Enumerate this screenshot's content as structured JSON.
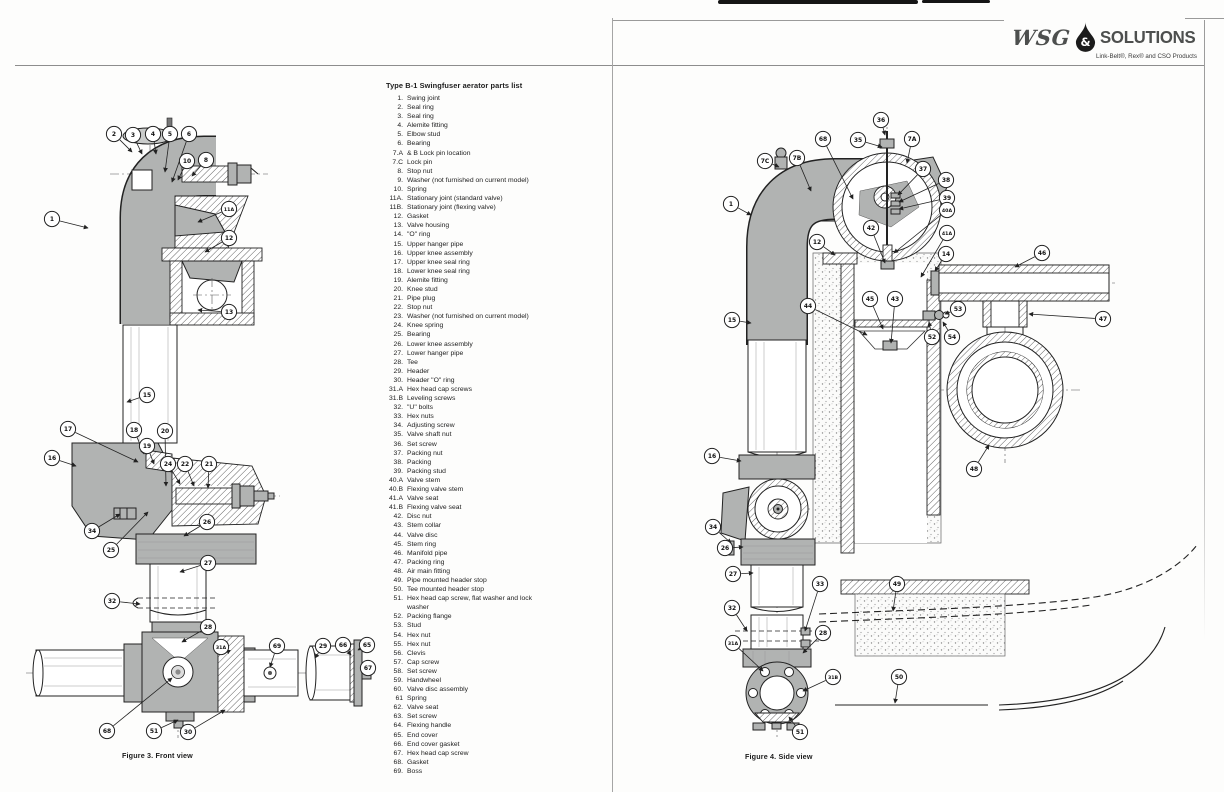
{
  "logo": {
    "wsg": "WSG",
    "amp": "&",
    "solutions": "SOLUTIONS",
    "tagline": "Link-Belt®, Rex® and CSO Products"
  },
  "parts_list": {
    "title": "Type B-1 Swingfuser aerator parts list",
    "items": [
      {
        "num": "1.",
        "label": "Swing joint"
      },
      {
        "num": "2.",
        "label": "Seal ring"
      },
      {
        "num": "3.",
        "label": "Seal ring"
      },
      {
        "num": "4.",
        "label": "Alemite fitting"
      },
      {
        "num": "5.",
        "label": "Elbow stud"
      },
      {
        "num": "6.",
        "label": "Bearing"
      },
      {
        "num": "7.A",
        "label": "& B Lock pin location"
      },
      {
        "num": "7.C",
        "label": "Lock pin"
      },
      {
        "num": "8.",
        "label": "Stop nut"
      },
      {
        "num": "9.",
        "label": "Washer (not furnished on current model)"
      },
      {
        "num": "10.",
        "label": "Spring"
      },
      {
        "num": "11A.",
        "label": "Stationary joint (standard valve)"
      },
      {
        "num": "11B.",
        "label": "Stationary joint (flexing valve)"
      },
      {
        "num": "12.",
        "label": "Gasket"
      },
      {
        "num": "13.",
        "label": "Valve housing"
      },
      {
        "num": "14.",
        "label": "\"O\" ring"
      },
      {
        "num": "15.",
        "label": "Upper hanger pipe"
      },
      {
        "num": "16.",
        "label": "Upper knee assembly"
      },
      {
        "num": "17.",
        "label": "Upper knee seal ring"
      },
      {
        "num": "18.",
        "label": "Lower knee seal ring"
      },
      {
        "num": "19.",
        "label": "Alemite fitting"
      },
      {
        "num": "20.",
        "label": "Knee stud"
      },
      {
        "num": "21.",
        "label": "Pipe plug"
      },
      {
        "num": "22.",
        "label": "Stop nut"
      },
      {
        "num": "23.",
        "label": "Washer (not furnished on current model)"
      },
      {
        "num": "24.",
        "label": "Knee spring"
      },
      {
        "num": "25.",
        "label": "Bearing"
      },
      {
        "num": "26.",
        "label": "Lower knee assembly"
      },
      {
        "num": "27.",
        "label": "Lower hanger pipe"
      },
      {
        "num": "28.",
        "label": "Tee"
      },
      {
        "num": "29.",
        "label": "Header"
      },
      {
        "num": "30.",
        "label": "Header \"O\" ring"
      },
      {
        "num": "31.A",
        "label": "Hex head cap screws"
      },
      {
        "num": "31.B",
        "label": "Leveling screws"
      },
      {
        "num": "32.",
        "label": "\"U\" bolts"
      },
      {
        "num": "33.",
        "label": "Hex nuts"
      },
      {
        "num": "34.",
        "label": "Adjusting screw"
      },
      {
        "num": "35.",
        "label": "Valve shaft nut"
      },
      {
        "num": "36.",
        "label": "Set screw"
      },
      {
        "num": "37.",
        "label": "Packing nut"
      },
      {
        "num": "38.",
        "label": "Packing"
      },
      {
        "num": "39.",
        "label": "Packing stud"
      },
      {
        "num": "40.A",
        "label": "Valve stem"
      },
      {
        "num": "40.B",
        "label": "Flexing valve stem"
      },
      {
        "num": "41.A",
        "label": "Valve seat"
      },
      {
        "num": "41.B",
        "label": "Flexing valve seat"
      },
      {
        "num": "42.",
        "label": "Disc nut"
      },
      {
        "num": "43.",
        "label": "Stem collar"
      },
      {
        "num": "44.",
        "label": "Valve disc"
      },
      {
        "num": "45.",
        "label": "Stem ring"
      },
      {
        "num": "46.",
        "label": "Manifold pipe"
      },
      {
        "num": "47.",
        "label": "Packing ring"
      },
      {
        "num": "48.",
        "label": "Air main fitting"
      },
      {
        "num": "49.",
        "label": "Pipe mounted header stop"
      },
      {
        "num": "50.",
        "label": "Tee mounted header stop"
      },
      {
        "num": "51.",
        "label": "Hex head cap screw, flat washer and lock washer"
      },
      {
        "num": "52.",
        "label": "Packing flange"
      },
      {
        "num": "53.",
        "label": "Stud"
      },
      {
        "num": "54.",
        "label": "Hex nut"
      },
      {
        "num": "55.",
        "label": "Hex nut"
      },
      {
        "num": "56.",
        "label": "Clevis"
      },
      {
        "num": "57.",
        "label": "Cap screw"
      },
      {
        "num": "58.",
        "label": "Set screw"
      },
      {
        "num": "59.",
        "label": "Handwheel"
      },
      {
        "num": "60.",
        "label": "Valve disc assembly"
      },
      {
        "num": "61",
        "label": "Spring"
      },
      {
        "num": "62.",
        "label": "Valve seat"
      },
      {
        "num": "63.",
        "label": "Set screw"
      },
      {
        "num": "64.",
        "label": "Flexing handle"
      },
      {
        "num": "65.",
        "label": "End cover"
      },
      {
        "num": "66.",
        "label": "End cover gasket"
      },
      {
        "num": "67.",
        "label": "Hex head cap screw"
      },
      {
        "num": "68.",
        "label": "Gasket"
      },
      {
        "num": "69.",
        "label": "Boss"
      }
    ]
  },
  "figure3": {
    "caption": "Figure 3. Front view",
    "callouts": [
      {
        "n": "2",
        "x": 94,
        "y": 24,
        "tx": 112,
        "ty": 42
      },
      {
        "n": "3",
        "x": 113,
        "y": 25,
        "tx": 122,
        "ty": 44
      },
      {
        "n": "4",
        "x": 133,
        "y": 24,
        "tx": 136,
        "ty": 44
      },
      {
        "n": "5",
        "x": 150,
        "y": 24,
        "tx": 145,
        "ty": 62
      },
      {
        "n": "6",
        "x": 169,
        "y": 24,
        "tx": 152,
        "ty": 72
      },
      {
        "n": "10",
        "x": 167,
        "y": 51,
        "tx": 158,
        "ty": 70
      },
      {
        "n": "8",
        "x": 186,
        "y": 50,
        "tx": 172,
        "ty": 66
      },
      {
        "n": "1",
        "x": 32,
        "y": 109,
        "tx": 68,
        "ty": 118
      },
      {
        "n": "11A",
        "x": 209,
        "y": 99,
        "tx": 178,
        "ty": 112
      },
      {
        "n": "12",
        "x": 209,
        "y": 128,
        "tx": 185,
        "ty": 142
      },
      {
        "n": "13",
        "x": 209,
        "y": 202,
        "tx": 178,
        "ty": 200
      },
      {
        "n": "15",
        "x": 127,
        "y": 285,
        "tx": 107,
        "ty": 292
      },
      {
        "n": "17",
        "x": 48,
        "y": 319,
        "tx": 118,
        "ty": 352
      },
      {
        "n": "18",
        "x": 114,
        "y": 320,
        "tx": 124,
        "ty": 344
      },
      {
        "n": "19",
        "x": 127,
        "y": 336,
        "tx": 134,
        "ty": 354
      },
      {
        "n": "20",
        "x": 145,
        "y": 321,
        "tx": 146,
        "ty": 376
      },
      {
        "n": "24",
        "x": 148,
        "y": 354,
        "tx": 160,
        "ty": 374
      },
      {
        "n": "22",
        "x": 165,
        "y": 354,
        "tx": 174,
        "ty": 376
      },
      {
        "n": "21",
        "x": 189,
        "y": 354,
        "tx": 188,
        "ty": 378
      },
      {
        "n": "16",
        "x": 32,
        "y": 348,
        "tx": 56,
        "ty": 356
      },
      {
        "n": "34",
        "x": 72,
        "y": 421,
        "tx": 100,
        "ty": 404
      },
      {
        "n": "25",
        "x": 91,
        "y": 440,
        "tx": 128,
        "ty": 402
      },
      {
        "n": "26",
        "x": 187,
        "y": 412,
        "tx": 164,
        "ty": 426
      },
      {
        "n": "27",
        "x": 188,
        "y": 453,
        "tx": 160,
        "ty": 462
      },
      {
        "n": "32",
        "x": 92,
        "y": 491,
        "tx": 120,
        "ty": 494
      },
      {
        "n": "28",
        "x": 188,
        "y": 517,
        "tx": 162,
        "ty": 532
      },
      {
        "n": "31A",
        "x": 201,
        "y": 537,
        "tx": 206,
        "ty": 540
      },
      {
        "n": "69",
        "x": 257,
        "y": 536,
        "tx": 250,
        "ty": 557
      },
      {
        "n": "29",
        "x": 303,
        "y": 536,
        "tx": 295,
        "ty": 548
      },
      {
        "n": "66",
        "x": 323,
        "y": 535,
        "tx": 331,
        "ty": 545
      },
      {
        "n": "65",
        "x": 347,
        "y": 535,
        "tx": 338,
        "ty": 540
      },
      {
        "n": "67",
        "x": 348,
        "y": 558,
        "tx": 345,
        "ty": 560
      },
      {
        "n": "68",
        "x": 87,
        "y": 621,
        "tx": 152,
        "ty": 568
      },
      {
        "n": "51",
        "x": 134,
        "y": 621,
        "tx": 158,
        "ty": 610
      },
      {
        "n": "30",
        "x": 168,
        "y": 622,
        "tx": 205,
        "ty": 600
      }
    ]
  },
  "figure4": {
    "caption": "Figure 4. Side view",
    "callouts": [
      {
        "n": "36",
        "x": 186,
        "y": 25,
        "tx": 190,
        "ty": 40
      },
      {
        "n": "35",
        "x": 163,
        "y": 45,
        "tx": 187,
        "ty": 52
      },
      {
        "n": "7A",
        "x": 217,
        "y": 44,
        "tx": 212,
        "ty": 68
      },
      {
        "n": "68",
        "x": 128,
        "y": 44,
        "tx": 158,
        "ty": 104
      },
      {
        "n": "7C",
        "x": 70,
        "y": 66,
        "tx": 84,
        "ty": 72
      },
      {
        "n": "7B",
        "x": 102,
        "y": 63,
        "tx": 116,
        "ty": 96
      },
      {
        "n": "37",
        "x": 228,
        "y": 74,
        "tx": 203,
        "ty": 100
      },
      {
        "n": "38",
        "x": 251,
        "y": 85,
        "tx": 204,
        "ty": 107
      },
      {
        "n": "39",
        "x": 252,
        "y": 103,
        "tx": 204,
        "ty": 114
      },
      {
        "n": "40A",
        "x": 252,
        "y": 115,
        "tx": 199,
        "ty": 158
      },
      {
        "n": "41A",
        "x": 252,
        "y": 138,
        "tx": 226,
        "ty": 182
      },
      {
        "n": "1",
        "x": 36,
        "y": 109,
        "tx": 56,
        "ty": 120
      },
      {
        "n": "12",
        "x": 122,
        "y": 147,
        "tx": 140,
        "ty": 160
      },
      {
        "n": "14",
        "x": 251,
        "y": 159,
        "tx": 240,
        "ty": 176
      },
      {
        "n": "42",
        "x": 176,
        "y": 133,
        "tx": 190,
        "ty": 168
      },
      {
        "n": "44",
        "x": 113,
        "y": 211,
        "tx": 172,
        "ty": 240
      },
      {
        "n": "45",
        "x": 175,
        "y": 204,
        "tx": 188,
        "ty": 234
      },
      {
        "n": "43",
        "x": 200,
        "y": 204,
        "tx": 196,
        "ty": 248
      },
      {
        "n": "15",
        "x": 37,
        "y": 225,
        "tx": 56,
        "ty": 228
      },
      {
        "n": "53",
        "x": 263,
        "y": 214,
        "tx": 250,
        "ty": 219
      },
      {
        "n": "52",
        "x": 237,
        "y": 242,
        "tx": 234,
        "ty": 227
      },
      {
        "n": "54",
        "x": 257,
        "y": 242,
        "tx": 248,
        "ty": 227
      },
      {
        "n": "46",
        "x": 347,
        "y": 158,
        "tx": 320,
        "ty": 172
      },
      {
        "n": "47",
        "x": 408,
        "y": 224,
        "tx": 334,
        "ty": 219
      },
      {
        "n": "48",
        "x": 279,
        "y": 374,
        "tx": 294,
        "ty": 350
      },
      {
        "n": "16",
        "x": 17,
        "y": 361,
        "tx": 46,
        "ty": 366
      },
      {
        "n": "34",
        "x": 18,
        "y": 432,
        "tx": 36,
        "ty": 448
      },
      {
        "n": "26",
        "x": 30,
        "y": 453,
        "tx": 48,
        "ty": 452
      },
      {
        "n": "27",
        "x": 38,
        "y": 479,
        "tx": 58,
        "ty": 478
      },
      {
        "n": "32",
        "x": 37,
        "y": 513,
        "tx": 52,
        "ty": 536
      },
      {
        "n": "33",
        "x": 125,
        "y": 489,
        "tx": 110,
        "ty": 536
      },
      {
        "n": "49",
        "x": 202,
        "y": 489,
        "tx": 198,
        "ty": 516
      },
      {
        "n": "28",
        "x": 128,
        "y": 538,
        "tx": 108,
        "ty": 558
      },
      {
        "n": "31A",
        "x": 38,
        "y": 548,
        "tx": 68,
        "ty": 576
      },
      {
        "n": "31B",
        "x": 138,
        "y": 582,
        "tx": 108,
        "ty": 596
      },
      {
        "n": "50",
        "x": 204,
        "y": 582,
        "tx": 200,
        "ty": 608
      },
      {
        "n": "51",
        "x": 105,
        "y": 637,
        "tx": 94,
        "ty": 622
      }
    ]
  },
  "colors": {
    "ink": "#1c1c1c",
    "metal_gray": "#b1b3b2",
    "rule_gray": "#8d8d8d",
    "page_bg": "#fdfdfc"
  }
}
